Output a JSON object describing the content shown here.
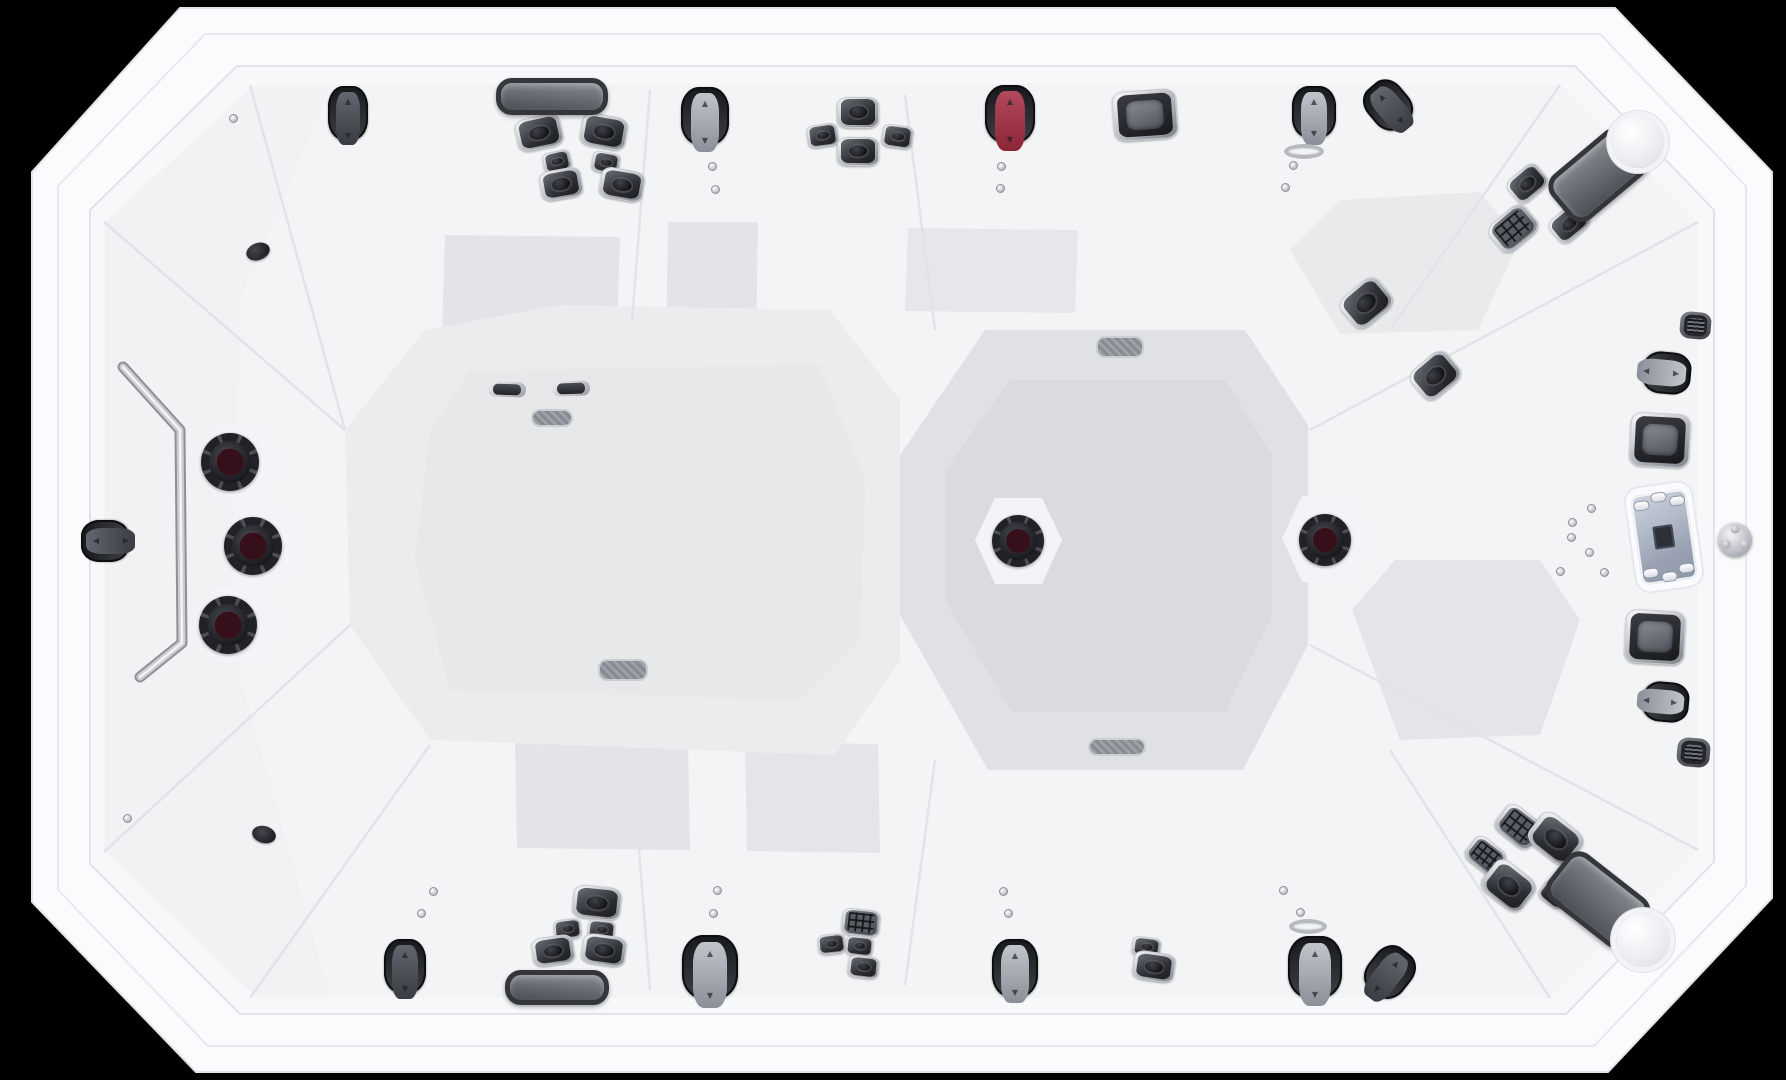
{
  "scene": {
    "description": "Overhead product photograph of a white rectangular swim-spa hot tub with clipped octagonal corners on a black background. Molded white acrylic shell with multiple seats, headrest pillows, clusters of stainless-trimmed hydrotherapy jets, red rotary massage jets, air/diverter toggle levers, a topside control panel with keypad on the right rim, chrome grab bar on the left, white filter-lid knobs in two corners and a recessed gray footwell in the right half.",
    "background_color": "#000000",
    "shell_white": "#f8f8fa",
    "rim_white": "#fbfbfd",
    "footwell_gray": "#dfe1e4",
    "jet_dark": "#2c2f34",
    "chrome": "#c7cacf",
    "accent_red": "#8e2838",
    "headrest_gray": "#565a61"
  },
  "components": {
    "headrests": [
      {
        "cx": 552,
        "cy": 96,
        "w": 112,
        "h": 37,
        "rot": 0
      },
      {
        "cx": 1598,
        "cy": 175,
        "w": 98,
        "h": 58,
        "rot": -40
      },
      {
        "cx": 557,
        "cy": 987,
        "w": 104,
        "h": 35,
        "rot": 0
      },
      {
        "cx": 1598,
        "cy": 900,
        "w": 102,
        "h": 60,
        "rot": 38
      }
    ],
    "jets": [
      {
        "v": "jet",
        "cx": 539,
        "cy": 132,
        "w": 46,
        "h": 33,
        "rot": -12
      },
      {
        "v": "jet",
        "cx": 604,
        "cy": 131,
        "w": 46,
        "h": 33,
        "rot": 10
      },
      {
        "v": "jet",
        "cx": 557,
        "cy": 161,
        "w": 28,
        "h": 21,
        "rot": -12
      },
      {
        "v": "jet",
        "cx": 606,
        "cy": 162,
        "w": 28,
        "h": 21,
        "rot": 10
      },
      {
        "v": "jet",
        "cx": 561,
        "cy": 184,
        "w": 42,
        "h": 30,
        "rot": -10
      },
      {
        "v": "jet",
        "cx": 622,
        "cy": 184,
        "w": 44,
        "h": 31,
        "rot": 10
      },
      {
        "v": "jet",
        "cx": 858,
        "cy": 112,
        "w": 42,
        "h": 31,
        "rot": 0
      },
      {
        "v": "jet",
        "cx": 822,
        "cy": 135,
        "w": 31,
        "h": 23,
        "rot": -8
      },
      {
        "v": "jet",
        "cx": 897,
        "cy": 136,
        "w": 31,
        "h": 23,
        "rot": 8
      },
      {
        "v": "jet",
        "cx": 858,
        "cy": 151,
        "w": 42,
        "h": 29,
        "rot": 0
      },
      {
        "v": "sq",
        "cx": 1145,
        "cy": 115,
        "w": 64,
        "h": 50,
        "rot": -4
      },
      {
        "v": "jet",
        "cx": 1527,
        "cy": 183,
        "w": 38,
        "h": 29,
        "rot": -40
      },
      {
        "v": "waffle",
        "cx": 1513,
        "cy": 228,
        "w": 46,
        "h": 35,
        "rot": -40
      },
      {
        "v": "jet",
        "cx": 1569,
        "cy": 223,
        "w": 38,
        "h": 29,
        "rot": -40
      },
      {
        "v": "jet",
        "cx": 1366,
        "cy": 303,
        "w": 48,
        "h": 38,
        "rot": -40
      },
      {
        "v": "jet",
        "cx": 1435,
        "cy": 375,
        "w": 46,
        "h": 37,
        "rot": -40
      },
      {
        "v": "mesh",
        "cx": 1695,
        "cy": 325,
        "w": 31,
        "h": 27,
        "rot": 5
      },
      {
        "v": "sq",
        "cx": 1660,
        "cy": 440,
        "w": 60,
        "h": 54,
        "rot": 3
      },
      {
        "v": "sq",
        "cx": 1655,
        "cy": 637,
        "w": 60,
        "h": 54,
        "rot": 3
      },
      {
        "v": "mesh",
        "cx": 1693,
        "cy": 752,
        "w": 33,
        "h": 29,
        "rot": 5
      },
      {
        "v": "waffle",
        "cx": 1519,
        "cy": 826,
        "w": 44,
        "h": 33,
        "rot": 38
      },
      {
        "v": "jet",
        "cx": 1556,
        "cy": 838,
        "w": 52,
        "h": 39,
        "rot": 38
      },
      {
        "v": "waffle",
        "cx": 1486,
        "cy": 855,
        "w": 38,
        "h": 29,
        "rot": 38
      },
      {
        "v": "jet",
        "cx": 1509,
        "cy": 885,
        "w": 50,
        "h": 39,
        "rot": 38
      },
      {
        "v": "jet",
        "cx": 1580,
        "cy": 866,
        "w": 27,
        "h": 21,
        "rot": 38
      },
      {
        "v": "jet",
        "cx": 1553,
        "cy": 894,
        "w": 27,
        "h": 21,
        "rot": 38
      },
      {
        "v": "jet",
        "cx": 597,
        "cy": 902,
        "w": 48,
        "h": 33,
        "rot": 6
      },
      {
        "v": "jet",
        "cx": 567,
        "cy": 929,
        "w": 27,
        "h": 20,
        "rot": -6
      },
      {
        "v": "jet",
        "cx": 601,
        "cy": 930,
        "w": 27,
        "h": 20,
        "rot": 6
      },
      {
        "v": "jet",
        "cx": 553,
        "cy": 950,
        "w": 42,
        "h": 29,
        "rot": -8
      },
      {
        "v": "jet",
        "cx": 604,
        "cy": 950,
        "w": 44,
        "h": 30,
        "rot": 8
      },
      {
        "v": "waffle",
        "cx": 861,
        "cy": 922,
        "w": 38,
        "h": 27,
        "rot": 6
      },
      {
        "v": "jet",
        "cx": 831,
        "cy": 944,
        "w": 27,
        "h": 20,
        "rot": -6
      },
      {
        "v": "jet",
        "cx": 859,
        "cy": 946,
        "w": 27,
        "h": 20,
        "rot": 6
      },
      {
        "v": "jet",
        "cx": 863,
        "cy": 967,
        "w": 31,
        "h": 22,
        "rot": 6
      },
      {
        "v": "jet",
        "cx": 1146,
        "cy": 947,
        "w": 29,
        "h": 20,
        "rot": 8
      },
      {
        "v": "jet",
        "cx": 1154,
        "cy": 966,
        "w": 42,
        "h": 29,
        "rot": 8
      },
      {
        "v": "slot",
        "cx": 507,
        "cy": 389,
        "w": 38,
        "h": 15,
        "rot": 2
      },
      {
        "v": "slot",
        "cx": 571,
        "cy": 388,
        "w": 38,
        "h": 15,
        "rot": -2
      }
    ],
    "rotary_jets": [
      {
        "cx": 230,
        "cy": 462,
        "d": 58
      },
      {
        "cx": 253,
        "cy": 546,
        "d": 58
      },
      {
        "cx": 228,
        "cy": 625,
        "d": 58
      },
      {
        "cx": 1018,
        "cy": 541,
        "d": 52
      },
      {
        "cx": 1325,
        "cy": 540,
        "d": 52
      }
    ],
    "toggles": [
      {
        "cx": 348,
        "cy": 113,
        "w": 40,
        "h": 54,
        "rot": 0,
        "lever": "dark"
      },
      {
        "cx": 705,
        "cy": 116,
        "w": 48,
        "h": 58,
        "rot": 0,
        "lever": "gray"
      },
      {
        "cx": 1010,
        "cy": 114,
        "w": 50,
        "h": 58,
        "rot": 0,
        "lever": "red"
      },
      {
        "cx": 1314,
        "cy": 112,
        "w": 44,
        "h": 52,
        "rot": 0,
        "lever": "gray"
      },
      {
        "cx": 1388,
        "cy": 105,
        "w": 42,
        "h": 50,
        "rot": -40,
        "lever": "dark"
      },
      {
        "cx": 1667,
        "cy": 373,
        "w": 42,
        "h": 48,
        "rot": 95,
        "lever": "gray"
      },
      {
        "cx": 1666,
        "cy": 702,
        "w": 40,
        "h": 46,
        "rot": 95,
        "lever": "gray"
      },
      {
        "cx": 105,
        "cy": 541,
        "w": 42,
        "h": 48,
        "rot": -90,
        "lever": "dark"
      },
      {
        "cx": 405,
        "cy": 966,
        "w": 42,
        "h": 54,
        "rot": 0,
        "lever": "dark"
      },
      {
        "cx": 710,
        "cy": 967,
        "w": 56,
        "h": 64,
        "rot": 0,
        "lever": "gray"
      },
      {
        "cx": 1015,
        "cy": 968,
        "w": 46,
        "h": 58,
        "rot": 0,
        "lever": "gray"
      },
      {
        "cx": 1315,
        "cy": 967,
        "w": 54,
        "h": 62,
        "rot": 0,
        "lever": "gray"
      },
      {
        "cx": 1390,
        "cy": 972,
        "w": 44,
        "h": 52,
        "rot": 38,
        "lever": "dark"
      }
    ],
    "white_knobs": [
      {
        "cx": 1638,
        "cy": 142,
        "d": 52
      },
      {
        "cx": 1643,
        "cy": 940,
        "d": 54
      }
    ],
    "dark_knobs": [
      {
        "cx": 258,
        "cy": 251,
        "w": 24,
        "h": 17,
        "rot": -20
      },
      {
        "cx": 264,
        "cy": 834,
        "w": 24,
        "h": 17,
        "rot": 15
      }
    ],
    "drains": [
      {
        "cx": 1120,
        "cy": 347,
        "w": 48,
        "h": 22
      },
      {
        "cx": 1117,
        "cy": 747,
        "w": 58,
        "h": 18
      },
      {
        "cx": 623,
        "cy": 670,
        "w": 50,
        "h": 22
      },
      {
        "cx": 552,
        "cy": 418,
        "w": 42,
        "h": 18
      }
    ],
    "chrome_rings": [
      {
        "cx": 1304,
        "cy": 151,
        "w": 40,
        "h": 15
      },
      {
        "cx": 1308,
        "cy": 926,
        "w": 38,
        "h": 15
      }
    ],
    "screws": [
      {
        "cx": 233,
        "cy": 118
      },
      {
        "cx": 712,
        "cy": 166
      },
      {
        "cx": 715,
        "cy": 189
      },
      {
        "cx": 1001,
        "cy": 166
      },
      {
        "cx": 1000,
        "cy": 188
      },
      {
        "cx": 1293,
        "cy": 165
      },
      {
        "cx": 1285,
        "cy": 187
      },
      {
        "cx": 127,
        "cy": 818
      },
      {
        "cx": 433,
        "cy": 891
      },
      {
        "cx": 421,
        "cy": 913
      },
      {
        "cx": 717,
        "cy": 890
      },
      {
        "cx": 713,
        "cy": 913
      },
      {
        "cx": 1003,
        "cy": 891
      },
      {
        "cx": 1008,
        "cy": 913
      },
      {
        "cx": 1283,
        "cy": 890
      },
      {
        "cx": 1300,
        "cy": 912
      },
      {
        "cx": 1572,
        "cy": 522
      },
      {
        "cx": 1591,
        "cy": 508
      },
      {
        "cx": 1589,
        "cy": 552
      },
      {
        "cx": 1571,
        "cy": 537
      },
      {
        "cx": 1604,
        "cy": 572
      },
      {
        "cx": 1560,
        "cy": 571
      }
    ],
    "control_panel": {
      "cx": 1664,
      "cy": 537,
      "w": 66,
      "h": 104,
      "rot": -8,
      "buttons": 6
    },
    "diverter_valve": {
      "cx": 1735,
      "cy": 540,
      "d": 34
    },
    "grab_bar": {
      "points": "123,367 180,430 182,643 140,677"
    }
  }
}
